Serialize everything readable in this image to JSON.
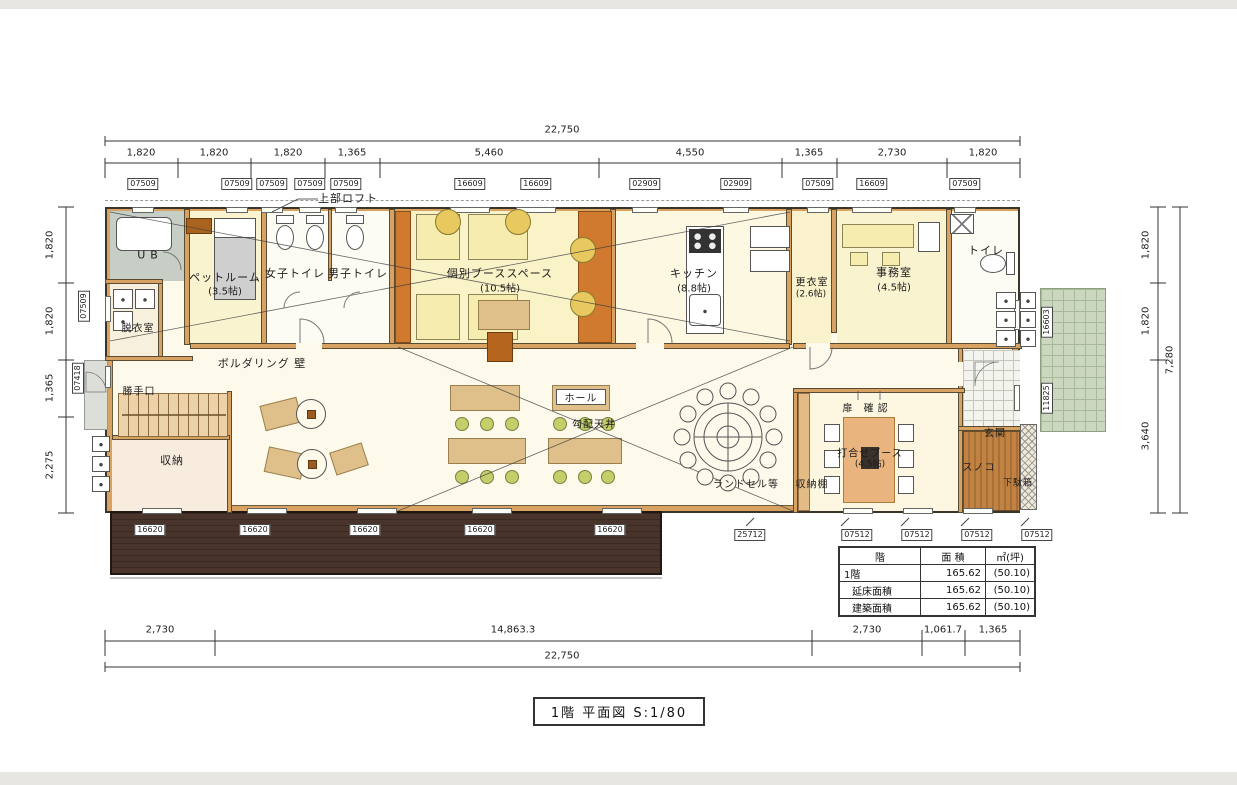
{
  "title_block": {
    "label": "1階 平面図 S:1/80"
  },
  "dims": {
    "top_total": "22,750",
    "top": [
      "1,820",
      "1,820",
      "1,820",
      "1,365",
      "5,460",
      "4,550",
      "1,365",
      "2,730",
      "1,820"
    ],
    "bottom": [
      "2,730",
      "14,863.3",
      "2,730",
      "1,061.7",
      "1,365"
    ],
    "bottom_total": "22,750",
    "left": [
      "1,820",
      "1,820",
      "1,365",
      "2,275"
    ],
    "right": [
      "1,820",
      "1,820",
      "3,640"
    ],
    "right_total": "7,280"
  },
  "codes": {
    "top": [
      "07509",
      "07509",
      "07509",
      "07509",
      "07509",
      "16609",
      "16609",
      "02909",
      "02909",
      "07509",
      "16609",
      "07509"
    ],
    "left": [
      "07509",
      "07418"
    ],
    "right": [
      "16603",
      "11825"
    ],
    "deck": [
      "16620",
      "16620",
      "16620",
      "16620",
      "16620"
    ],
    "bottom": [
      "25712",
      "07512",
      "07512",
      "07512",
      "07512"
    ]
  },
  "rooms": {
    "loft_note": "上部ロフト",
    "ub": "UB",
    "pet_room": "ペットルーム",
    "pet_room_size": "(3.5帖)",
    "womens_toilet": "女子トイレ",
    "mens_toilet": "男子トイレ",
    "booth_space": "個別ブーススペース",
    "booth_space_size": "(10.5帖)",
    "kitchen": "キッチン",
    "kitchen_size": "(8.8帖)",
    "changing_room": "更衣室",
    "changing_room_size": "(2.6帖)",
    "office": "事務室",
    "office_size": "(4.5帖)",
    "toilet": "トイレ",
    "dressing_room": "脱衣室",
    "bouldering": "ボルダリング 壁",
    "kitchen_door": "勝手口",
    "storage": "収納",
    "hall": "ホール",
    "sloped_ceiling": "勾配天井",
    "randoseru": "ランドセル等",
    "shelf": "収納棚",
    "meeting_booth": "打合せブース",
    "meeting_booth_size": "(4.5帖)",
    "door_check": "扉 確認",
    "entrance": "玄関",
    "sunoko": "スノコ",
    "shoe_box": "下駄箱"
  },
  "area_table": {
    "col_floor": "階",
    "col_area": "面 積",
    "col_unit": "㎡(坪)",
    "rows": [
      {
        "floor": "1階",
        "area": "165.62",
        "tsubo": "(50.10)"
      },
      {
        "floor": "延床面積",
        "area": "165.62",
        "tsubo": "(50.10)"
      },
      {
        "floor": "建築面積",
        "area": "165.62",
        "tsubo": "(50.10)"
      }
    ]
  },
  "colors": {
    "wall_wood": "#d8a263",
    "deck_brown": "#46322a",
    "booth_orange": "#cf7a2e",
    "room_cream": "#faf4d2",
    "porch_green": "#cbd7bf"
  }
}
